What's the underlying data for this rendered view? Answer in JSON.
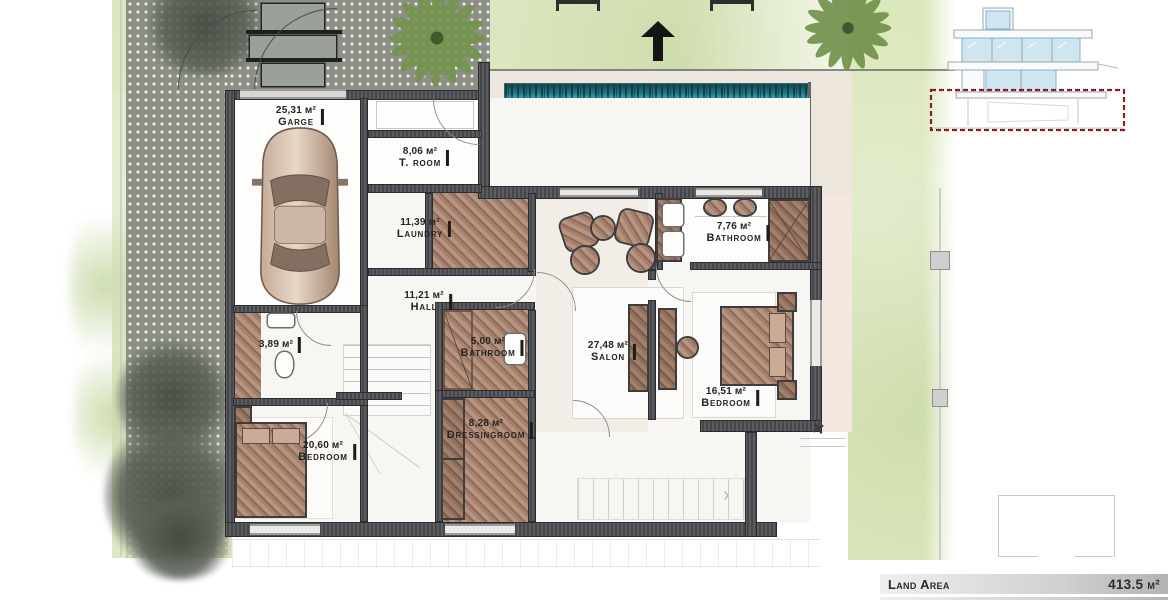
{
  "site": {
    "summary": [
      {
        "label": "Land Area",
        "value": "413.5 м²"
      },
      {
        "label": "Total area on the floor",
        "value": "233.1 м²"
      }
    ]
  },
  "rooms": [
    {
      "area": "25,31 м²",
      "name": "Garge"
    },
    {
      "area": "8,06 м²",
      "name": "T. room"
    },
    {
      "area": "11,39 м²",
      "name": "Laundry"
    },
    {
      "area": "11,21 м²",
      "name": "Hall"
    },
    {
      "area": "5,00 м²",
      "name": "Bathroom"
    },
    {
      "area": "8,28 м²",
      "name": "Dressingroom"
    },
    {
      "area": "27,48 м²",
      "name": "Salon"
    },
    {
      "area": "7,76 м²",
      "name": "Bathroom"
    },
    {
      "area": "16,51 м²",
      "name": "Bedroom"
    },
    {
      "area": "3,89 м²",
      "name": ""
    },
    {
      "area": "20,60 м²",
      "name": "Bedroom"
    }
  ],
  "colors": {
    "pool": "#3BCFDD",
    "walls": "#4E4F54",
    "wood_floor": "#9C7A67",
    "grass": "#D8E5B8",
    "paving": "#8B8F86",
    "terrace": "#ECE6DC",
    "highlight_red": "#8B1F1F"
  }
}
